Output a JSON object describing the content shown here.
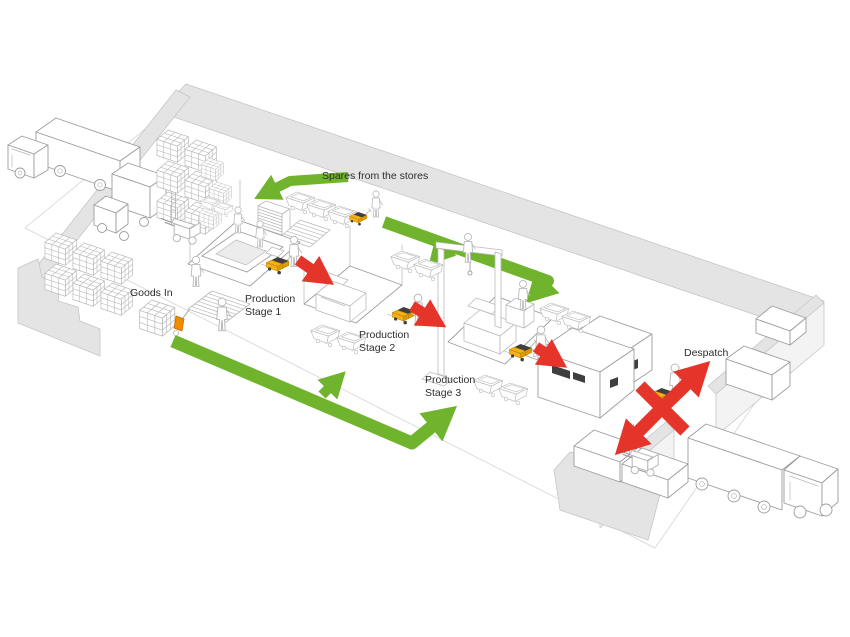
{
  "diagram": {
    "type": "isometric-warehouse-flow-diagram",
    "labels": {
      "spares": "Spares from the stores",
      "goods_in": "Goods In",
      "stage1_line1": "Production",
      "stage1_line2": "Stage 1",
      "stage2_line1": "Production",
      "stage2_line2": "Stage 2",
      "stage3_line1": "Production",
      "stage3_line2": "Stage 3",
      "despatch": "Despatch"
    },
    "colors": {
      "flow_green": "#70b42d",
      "flow_red": "#e5352b",
      "vehicle_yellow": "#f6b119",
      "vehicle_yellow_dark": "#e09a00",
      "hand_truck_orange": "#f08c00",
      "wall_gray": "#e4e4e5",
      "wall_edge": "#c6c6c7",
      "outline": "#9d9d9c",
      "dark_detail": "#3f3f3f",
      "text": "#2d2d2d"
    },
    "flows": {
      "green": [
        "spares-from-stores-to-stage1",
        "stores-line-to-stage2",
        "stores-line-to-stage3",
        "goods-in-to-stage2",
        "goods-in-to-stage3"
      ],
      "red": [
        "stage1-to-stage2",
        "stage2-to-stage3",
        "stage3-to-despatch",
        "despatch-bay-exchange"
      ]
    },
    "icons": [
      "inbound-truck",
      "box-van",
      "outbound-truck",
      "forklift",
      "pallet-truck",
      "hand-truck",
      "worker",
      "crate-stack",
      "parts-bin",
      "pallet-stack",
      "sheet-stack",
      "production-platform",
      "machine",
      "gantry-crane",
      "control-console",
      "despatch-building",
      "loading-dock",
      "container"
    ]
  }
}
